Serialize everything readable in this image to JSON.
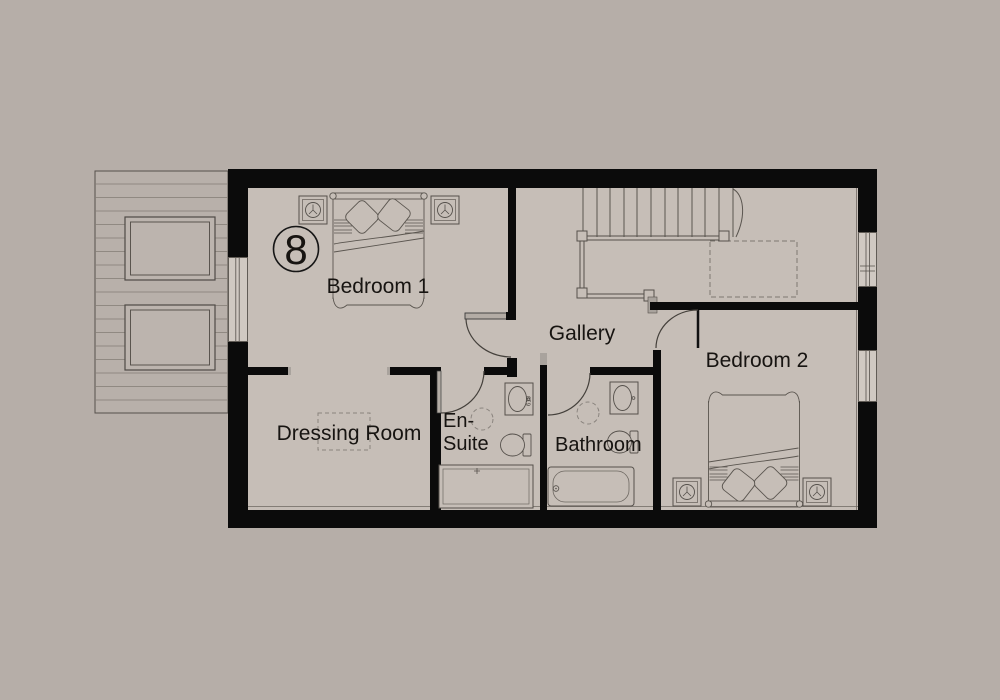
{
  "badge": {
    "number": "8"
  },
  "rooms": {
    "bedroom1": {
      "label": "Bedroom 1"
    },
    "gallery": {
      "label": "Gallery"
    },
    "bedroom2": {
      "label": "Bedroom 2"
    },
    "dressing_room": {
      "label": "Dressing Room"
    },
    "ensuite": {
      "label_line1": "En-",
      "label_line2": "Suite"
    },
    "bathroom": {
      "label": "Bathroom"
    }
  },
  "annotations": {
    "sink_width_label": "610"
  },
  "colors": {
    "background": "#b6aea8",
    "floor": "#c6beb7",
    "roof": "#b8b0aa",
    "wall": "#0b0b0b",
    "line": "#55504b",
    "dashed": "#8a847e",
    "window_fill": "#d0c9c2",
    "text": "#171411"
  }
}
